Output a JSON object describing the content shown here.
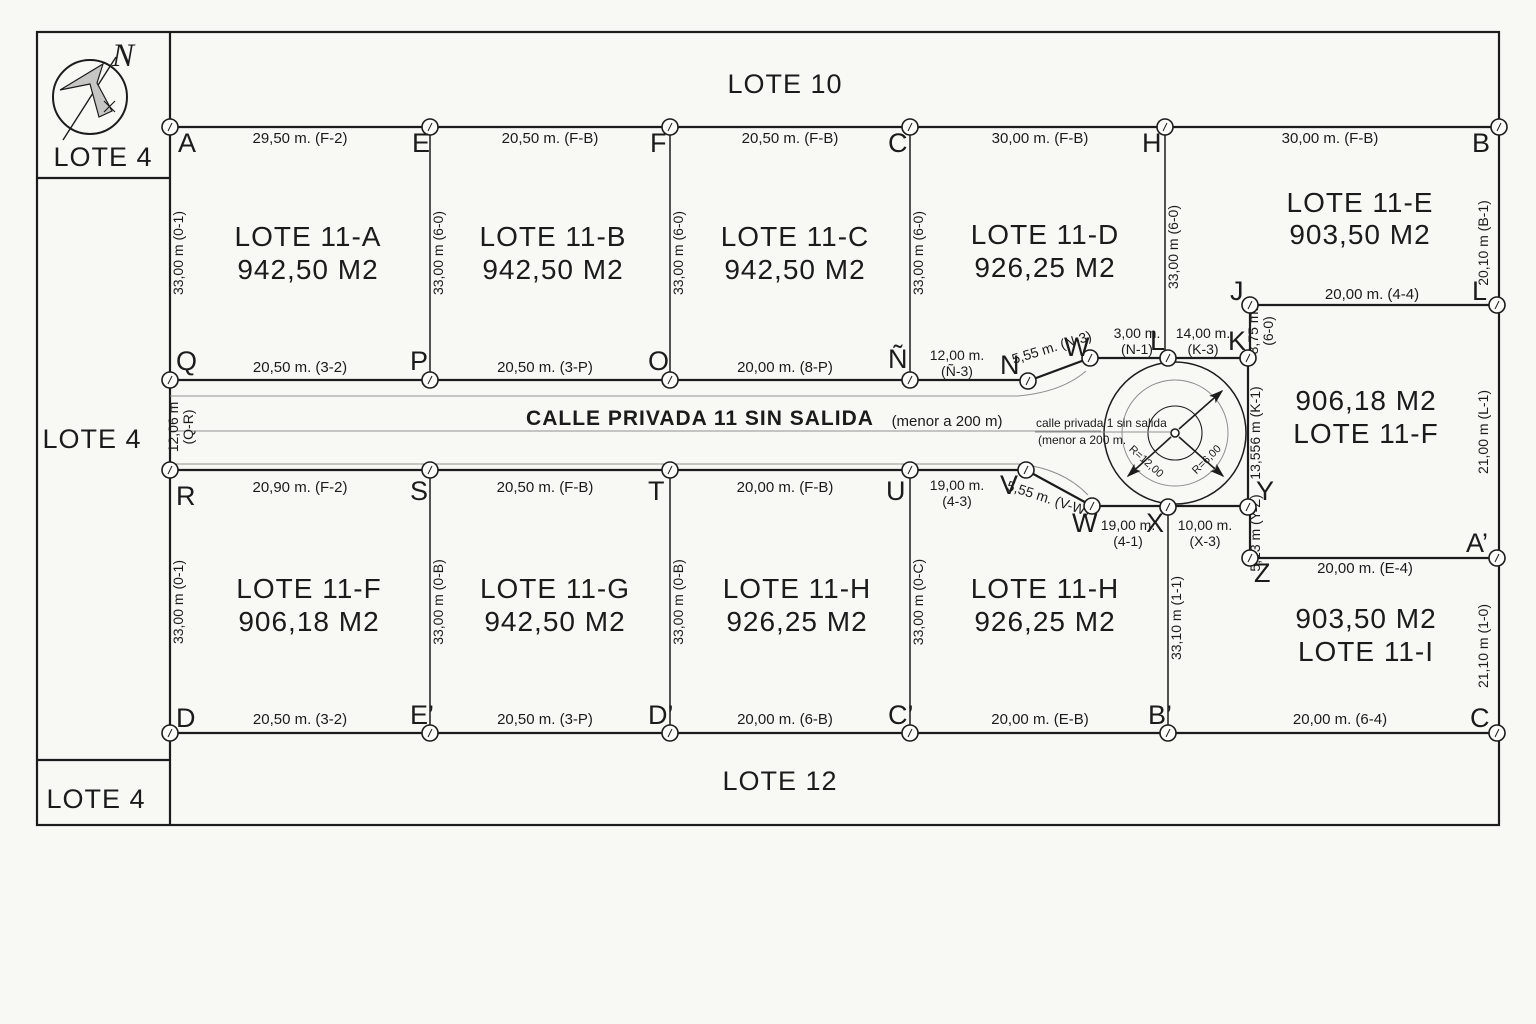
{
  "labels": {
    "lote10": "LOTE 10",
    "lote12": "LOTE 12",
    "lote4_top": "LOTE 4",
    "lote4_mid": "LOTE 4",
    "lote4_bot": "LOTE 4",
    "north": "N"
  },
  "street": {
    "name": "CALLE PRIVADA 11 SIN SALIDA",
    "limit_note": "(menor a 200 m)",
    "small_line1": "calle privada 1 sin salida",
    "small_line2": "(menor a 200 m.",
    "width_dim_value": "12,06 m",
    "width_dim_ref": "(Q-R)"
  },
  "culdesac": {
    "radius_outer": "R=12,00",
    "radius_inner": "R=6,00"
  },
  "lots": {
    "a": {
      "name": "LOTE 11-A",
      "area": "942,50 M2"
    },
    "b": {
      "name": "LOTE 11-B",
      "area": "942,50 M2"
    },
    "c": {
      "name": "LOTE 11-C",
      "area": "942,50 M2"
    },
    "d": {
      "name": "LOTE 11-D",
      "area": "926,25 M2"
    },
    "e": {
      "name": "LOTE 11-E",
      "area": "903,50 M2"
    },
    "f_right": {
      "area": "906,18 M2",
      "name": "LOTE 11-F"
    },
    "f": {
      "name": "LOTE 11-F",
      "area": "906,18 M2"
    },
    "g": {
      "name": "LOTE 11-G",
      "area": "942,50 M2"
    },
    "h1": {
      "name": "LOTE 11-H",
      "area": "926,25 M2"
    },
    "h2": {
      "name": "LOTE 11-H",
      "area": "926,25 M2"
    },
    "i": {
      "area": "903,50 M2",
      "name": "LOTE 11-I"
    }
  },
  "dims": {
    "a_top": "29,50 m. (F-2)",
    "b_top": "20,50 m. (F-B)",
    "c_top": "20,50 m. (F-B)",
    "d_top": "30,00 m. (F-B)",
    "e_top": "30,00 m. (F-B)",
    "a_bot": "20,50 m. (3-2)",
    "b_bot": "20,50 m. (3-P)",
    "c_bot": "20,00 m. (8-P)",
    "n_dim_l1": "12,00 m.",
    "n_dim_l2": "(Ñ-3)",
    "nw_diag": "5,55 m. (N-3)",
    "wl_l1": "3,00 m.",
    "wl_l2": "(N-1)",
    "lk_l1": "14,00 m.",
    "lk_l2": "(K-3)",
    "jl_top": "20,00 m. (4-4)",
    "jk_l1": "8,75 m.",
    "jk_l2": "(6-0)",
    "bl_right": "20,10 m (B-1)",
    "ky": "13,556 m (K-1)",
    "fr_right": "21,00 m (L-1)",
    "yz": "5,13 m (Y-Z)",
    "za": "20,00 m. (E-4)",
    "i_right": "21,10 m (1-0)",
    "a_left": "33,00 m (0-1)",
    "b_left": "33,00 m (6-0)",
    "c_left": "33,00 m (6-0)",
    "d_left": "33,00 m (6-0)",
    "e_left": "33,00 m (6-0)",
    "f_top": "20,90 m. (F-2)",
    "g_top": "20,50 m. (F-B)",
    "h1_top": "20,00 m. (F-B)",
    "uv_l1": "19,00 m.",
    "uv_l2": "(4-3)",
    "vw_diag": "5,55 m. (V-W)",
    "wx_l1": "19,00 m.",
    "wx_l2": "(4-1)",
    "xy_l1": "10,00 m.",
    "xy_l2": "(X-3)",
    "f_bot": "20,50 m. (3-2)",
    "g_bot": "20,50 m. (3-P)",
    "h1_bot": "20,00 m. (6-B)",
    "h2_bot": "20,00 m. (E-B)",
    "i_bot": "20,00 m. (6-4)",
    "f_left": "33,00 m (0-1)",
    "g_left": "33,00 m (0-B)",
    "h1_left": "33,00 m (0-B)",
    "h2_left": "33,00 m (0-C)",
    "xb_left": "33,10 m (1-1)"
  },
  "vertices": {
    "A": "A",
    "E": "E",
    "F": "F",
    "C": "C",
    "H": "H",
    "B": "B",
    "Q": "Q",
    "P": "P",
    "O": "O",
    "NT": "Ñ",
    "N": "N",
    "W1": "W",
    "L1": "L",
    "K": "K",
    "J": "J",
    "L2": "L",
    "R": "R",
    "S": "S",
    "T": "T",
    "U": "U",
    "V": "V",
    "W2": "W",
    "X": "X",
    "Y": "Y",
    "Z": "Z",
    "AP": "A’",
    "D": "D",
    "EP": "E’",
    "DP": "D’",
    "CP": "C’",
    "BP": "B’",
    "C2": "C"
  }
}
